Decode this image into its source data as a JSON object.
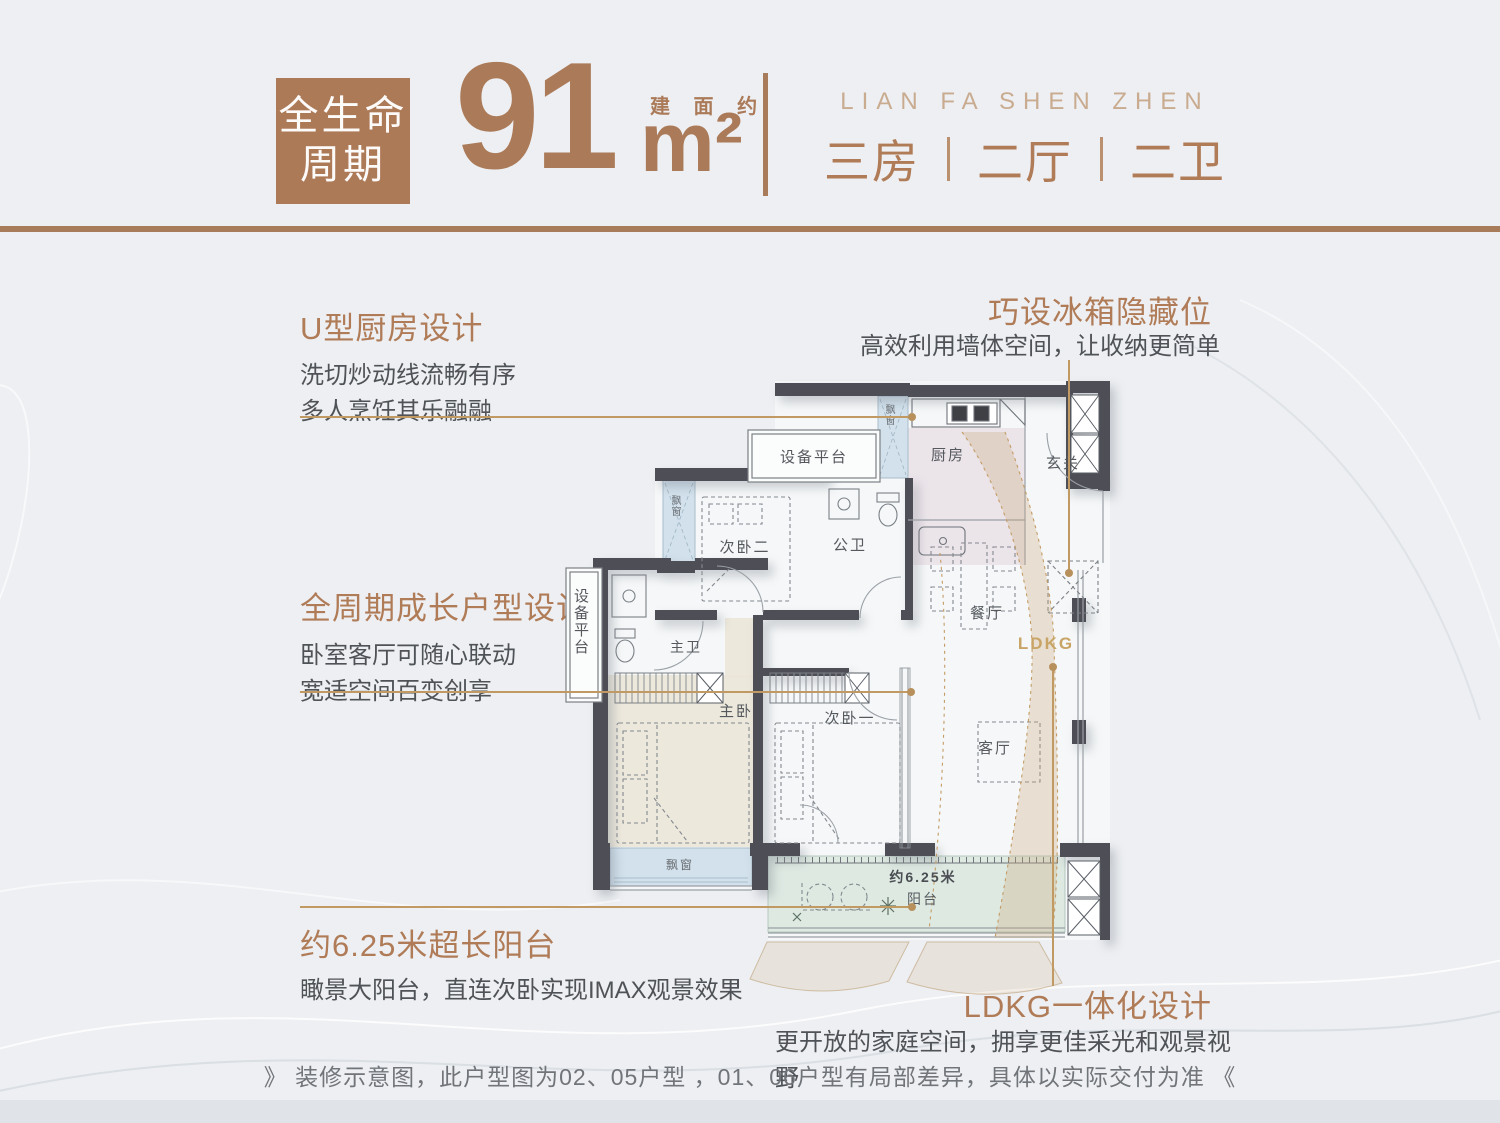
{
  "header": {
    "badge_line1": "全生命",
    "badge_line2": "周期",
    "area_value": "91",
    "area_prefix": "建 面 约",
    "area_unit": "m²",
    "brand": "LIAN FA SHEN ZHEN",
    "layout_parts": [
      "三房",
      "二厅",
      "二卫"
    ]
  },
  "callouts": {
    "kitchen": {
      "title": "U型厨房设计",
      "lines": [
        "洗切炒动线流畅有序",
        "多人烹饪其乐融融"
      ]
    },
    "fridge": {
      "title": "巧设冰箱隐藏位",
      "body": "高效利用墙体空间，让收纳更简单"
    },
    "growth": {
      "title": "全周期成长户型设计",
      "lines": [
        "卧室客厅可随心联动",
        "宽适空间百变创享"
      ]
    },
    "balcony": {
      "title": "约6.25米超长阳台",
      "body": "瞰景大阳台，直连次卧实现IMAX观景效果"
    },
    "ldkg": {
      "title": "LDKG一体化设计",
      "body": "更开放的家庭空间，拥享更佳采光和观景视野"
    }
  },
  "plan": {
    "equip_top": "设备平台",
    "equip_left": "设备平台",
    "bay_kitchen": "飘窗",
    "bay_bed2": "飘窗",
    "bay_master": "飘窗",
    "bedroom2": "次卧二",
    "public_bath": "公卫",
    "kitchen": "厨房",
    "foyer": "玄关",
    "dining": "餐厅",
    "master_bath": "主卫",
    "master_bedroom": "主卧",
    "bedroom1": "次卧一",
    "living": "客厅",
    "ldkg": "LDKG",
    "balcony_length": "约6.25米",
    "balcony": "阳台"
  },
  "footer": {
    "disclaimer": "》 装修示意图，此户型图为02、05户型 ，01、06户型有局部差异，具体以实际交付为准 《"
  },
  "colors": {
    "accent_brown": "#ad7a58",
    "brand_light_brown": "#c9ab90",
    "leader_tan": "#c19a63",
    "wall_dark": "#4e4e56",
    "bay_window_blue": "#d2e1ec",
    "bedroom_beige": "#ebe5d8",
    "kitchen_pink": "#e9e1e6",
    "balcony_green": "#dee9e2",
    "body_text": "#4f5357"
  }
}
